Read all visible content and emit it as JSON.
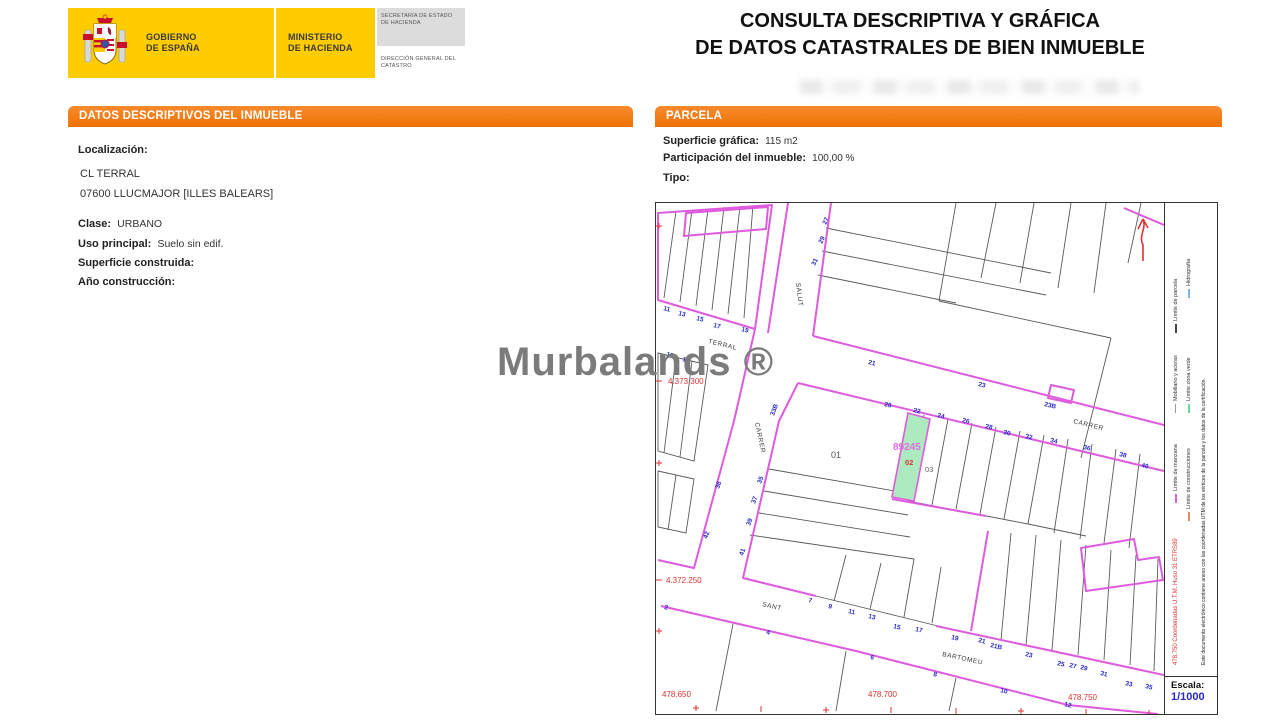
{
  "header": {
    "title_line1": "CONSULTA DESCRIPTIVA Y GRÁFICA",
    "title_line2": "DE DATOS CATASTRALES DE BIEN INMUEBLE",
    "logo": {
      "gobierno_line1": "GOBIERNO",
      "gobierno_line2": "DE ESPAÑA",
      "ministerio_line1": "MINISTERIO",
      "ministerio_line2": "DE HACIENDA",
      "secretaria": "SECRETARÍA DE ESTADO DE HACIENDA",
      "direccion": "DIRECCIÓN GENERAL DEL CATASTRO"
    }
  },
  "watermark": "Murbalands ®",
  "left_panel": {
    "header": "DATOS DESCRIPTIVOS DEL INMUEBLE",
    "localizacion_label": "Localización:",
    "address_line1": "CL TERRAL",
    "address_line2": "07600 LLUCMAJOR [ILLES BALEARS]",
    "clase_label": "Clase:",
    "clase_value": "URBANO",
    "uso_label": "Uso principal:",
    "uso_value": "Suelo sin edif.",
    "superficie_label": "Superficie construida:",
    "superficie_value": "",
    "anio_label": "Año construcción:",
    "anio_value": ""
  },
  "right_panel": {
    "header": "PARCELA",
    "superficie_label": "Superficie gráfica:",
    "superficie_value": "115 m2",
    "participacion_label": "Participación del inmueble:",
    "participacion_value": "100,00 %",
    "tipo_label": "Tipo:",
    "tipo_value": ""
  },
  "map": {
    "highlight_parcel": "89245",
    "escala_label": "Escala:",
    "escala_value": "1/1000",
    "legend": {
      "items": [
        {
          "label": "Límite de manzana",
          "color": "#DE5BDE"
        },
        {
          "label": "Límite de construcciones",
          "color": "#E08868"
        },
        {
          "label": "Límite de parcela",
          "color": "#444444"
        },
        {
          "label": "Mobiliario y aceras",
          "color": "#9A9A9A"
        },
        {
          "label": "Hidrografía",
          "color": "#7FB2E5"
        },
        {
          "label": "Límite zona verde",
          "color": "#5FD9A0"
        }
      ],
      "utm_note": "478.750 Coordenadas U.T.M. Huso 31 ETRS89",
      "doc_note": "Este documento electrónico contiene anexo con las coordenadas UTM de los vértices de la parcela y los datos de la certificación."
    },
    "labels": [
      {
        "t": "11",
        "x": 7,
        "y": 107,
        "r": 15,
        "c": "hn"
      },
      {
        "t": "13",
        "x": 22,
        "y": 112,
        "r": 15,
        "c": "hn"
      },
      {
        "t": "15",
        "x": 40,
        "y": 117,
        "r": 15,
        "c": "hn"
      },
      {
        "t": "17",
        "x": 57,
        "y": 124,
        "r": 15,
        "c": "hn"
      },
      {
        "t": "19",
        "x": 85,
        "y": 128,
        "r": 15,
        "c": "hn"
      },
      {
        "t": "12",
        "x": 10,
        "y": 153,
        "r": 15,
        "c": "hn"
      },
      {
        "t": "14",
        "x": 26,
        "y": 158,
        "r": 15,
        "c": "hn"
      },
      {
        "t": "27",
        "x": 170,
        "y": 22,
        "r": -65,
        "c": "hn"
      },
      {
        "t": "29",
        "x": 166,
        "y": 41,
        "r": -65,
        "c": "hn"
      },
      {
        "t": "31",
        "x": 159,
        "y": 63,
        "r": -65,
        "c": "hn"
      },
      {
        "t": "21",
        "x": 212,
        "y": 161,
        "r": 13,
        "c": "hn"
      },
      {
        "t": "23",
        "x": 322,
        "y": 183,
        "r": 13,
        "c": "hn"
      },
      {
        "t": "23B",
        "x": 388,
        "y": 203,
        "r": 13,
        "c": "hn"
      },
      {
        "t": "20",
        "x": 228,
        "y": 203,
        "r": 13,
        "c": "hn"
      },
      {
        "t": "22",
        "x": 257,
        "y": 209,
        "r": 13,
        "c": "hn"
      },
      {
        "t": "24",
        "x": 281,
        "y": 214,
        "r": 13,
        "c": "hn"
      },
      {
        "t": "26",
        "x": 306,
        "y": 219,
        "r": 13,
        "c": "hn"
      },
      {
        "t": "28",
        "x": 329,
        "y": 225,
        "r": 13,
        "c": "hn"
      },
      {
        "t": "30",
        "x": 347,
        "y": 231,
        "r": 13,
        "c": "hn"
      },
      {
        "t": "32",
        "x": 369,
        "y": 235,
        "r": 13,
        "c": "hn"
      },
      {
        "t": "34",
        "x": 394,
        "y": 239,
        "r": 13,
        "c": "hn"
      },
      {
        "t": "36",
        "x": 427,
        "y": 246,
        "r": 13,
        "c": "hn"
      },
      {
        "t": "38",
        "x": 463,
        "y": 253,
        "r": 13,
        "c": "hn"
      },
      {
        "t": "40",
        "x": 485,
        "y": 264,
        "r": 13,
        "c": "hn"
      },
      {
        "t": "33B",
        "x": 118,
        "y": 213,
        "r": -70,
        "c": "hn"
      },
      {
        "t": "35",
        "x": 105,
        "y": 281,
        "r": -70,
        "c": "hn"
      },
      {
        "t": "37",
        "x": 99,
        "y": 301,
        "r": -70,
        "c": "hn"
      },
      {
        "t": "39",
        "x": 94,
        "y": 323,
        "r": -70,
        "c": "hn"
      },
      {
        "t": "41",
        "x": 87,
        "y": 353,
        "r": -70,
        "c": "hn"
      },
      {
        "t": "36",
        "x": 63,
        "y": 286,
        "r": -70,
        "c": "hn"
      },
      {
        "t": "42",
        "x": 51,
        "y": 336,
        "r": -70,
        "c": "hn"
      },
      {
        "t": "2",
        "x": 8,
        "y": 406,
        "r": 13,
        "c": "hn"
      },
      {
        "t": "4",
        "x": 110,
        "y": 431,
        "r": 13,
        "c": "hn"
      },
      {
        "t": "6",
        "x": 214,
        "y": 456,
        "r": 13,
        "c": "hn"
      },
      {
        "t": "7",
        "x": 152,
        "y": 399,
        "r": 13,
        "c": "hn"
      },
      {
        "t": "9",
        "x": 172,
        "y": 405,
        "r": 13,
        "c": "hn"
      },
      {
        "t": "11",
        "x": 192,
        "y": 410,
        "r": 13,
        "c": "hn"
      },
      {
        "t": "13",
        "x": 212,
        "y": 415,
        "r": 13,
        "c": "hn"
      },
      {
        "t": "15",
        "x": 237,
        "y": 425,
        "r": 13,
        "c": "hn"
      },
      {
        "t": "17",
        "x": 259,
        "y": 428,
        "r": 13,
        "c": "hn"
      },
      {
        "t": "19",
        "x": 295,
        "y": 436,
        "r": 13,
        "c": "hn"
      },
      {
        "t": "21",
        "x": 322,
        "y": 439,
        "r": 13,
        "c": "hn"
      },
      {
        "t": "21B",
        "x": 334,
        "y": 444,
        "r": 13,
        "c": "hn"
      },
      {
        "t": "23",
        "x": 369,
        "y": 453,
        "r": 13,
        "c": "hn"
      },
      {
        "t": "25",
        "x": 401,
        "y": 462,
        "r": 13,
        "c": "hn"
      },
      {
        "t": "27",
        "x": 413,
        "y": 464,
        "r": 13,
        "c": "hn"
      },
      {
        "t": "29",
        "x": 424,
        "y": 466,
        "r": 13,
        "c": "hn"
      },
      {
        "t": "31",
        "x": 444,
        "y": 472,
        "r": 13,
        "c": "hn"
      },
      {
        "t": "33",
        "x": 469,
        "y": 482,
        "r": 13,
        "c": "hn"
      },
      {
        "t": "35",
        "x": 489,
        "y": 485,
        "r": 13,
        "c": "hn"
      },
      {
        "t": "8",
        "x": 277,
        "y": 473,
        "r": 13,
        "c": "hn"
      },
      {
        "t": "10",
        "x": 344,
        "y": 489,
        "r": 13,
        "c": "hn"
      },
      {
        "t": "12",
        "x": 408,
        "y": 503,
        "r": 13,
        "c": "hn"
      },
      {
        "t": "TERRAL",
        "x": 52,
        "y": 140,
        "r": 14,
        "c": "st"
      },
      {
        "t": "SALUT",
        "x": 140,
        "y": 80,
        "r": 83,
        "c": "st"
      },
      {
        "t": "CARRER",
        "x": 99,
        "y": 220,
        "r": 78,
        "c": "st"
      },
      {
        "t": "CARRER",
        "x": 417,
        "y": 220,
        "r": 14,
        "c": "st"
      },
      {
        "t": "SANT",
        "x": 106,
        "y": 403,
        "r": 13,
        "c": "st"
      },
      {
        "t": "BARTOMEU",
        "x": 286,
        "y": 453,
        "r": 12,
        "c": "st"
      },
      {
        "t": "4.373.300",
        "x": 12,
        "y": 181,
        "r": 0,
        "c": "coord"
      },
      {
        "t": "4.372.250",
        "x": 10,
        "y": 380,
        "r": 0,
        "c": "coord"
      },
      {
        "t": "478.650",
        "x": 6,
        "y": 494,
        "r": 0,
        "c": "coord"
      },
      {
        "t": "478.700",
        "x": 212,
        "y": 494,
        "r": 0,
        "c": "coord"
      },
      {
        "t": "478.750",
        "x": 412,
        "y": 497,
        "r": 0,
        "c": "coord"
      },
      {
        "t": "89245",
        "x": 237,
        "y": 247,
        "r": 0,
        "c": "pid"
      },
      {
        "t": "02",
        "x": 249,
        "y": 262,
        "r": 0,
        "c": "subr"
      },
      {
        "t": "03",
        "x": 269,
        "y": 269,
        "r": 0,
        "c": "subg"
      },
      {
        "t": "01",
        "x": 175,
        "y": 255,
        "r": 0,
        "c": "blk"
      }
    ]
  },
  "colors": {
    "orange_header": "#F4791F",
    "magenta_line": "#DE5BDE",
    "house_number_blue": "#2929C8",
    "coordinate_red": "#E03131",
    "parcel_green_fill": "#ADEABF",
    "logo_yellow": "#FFCC00",
    "watermark_gray": "#7B7B7B"
  }
}
